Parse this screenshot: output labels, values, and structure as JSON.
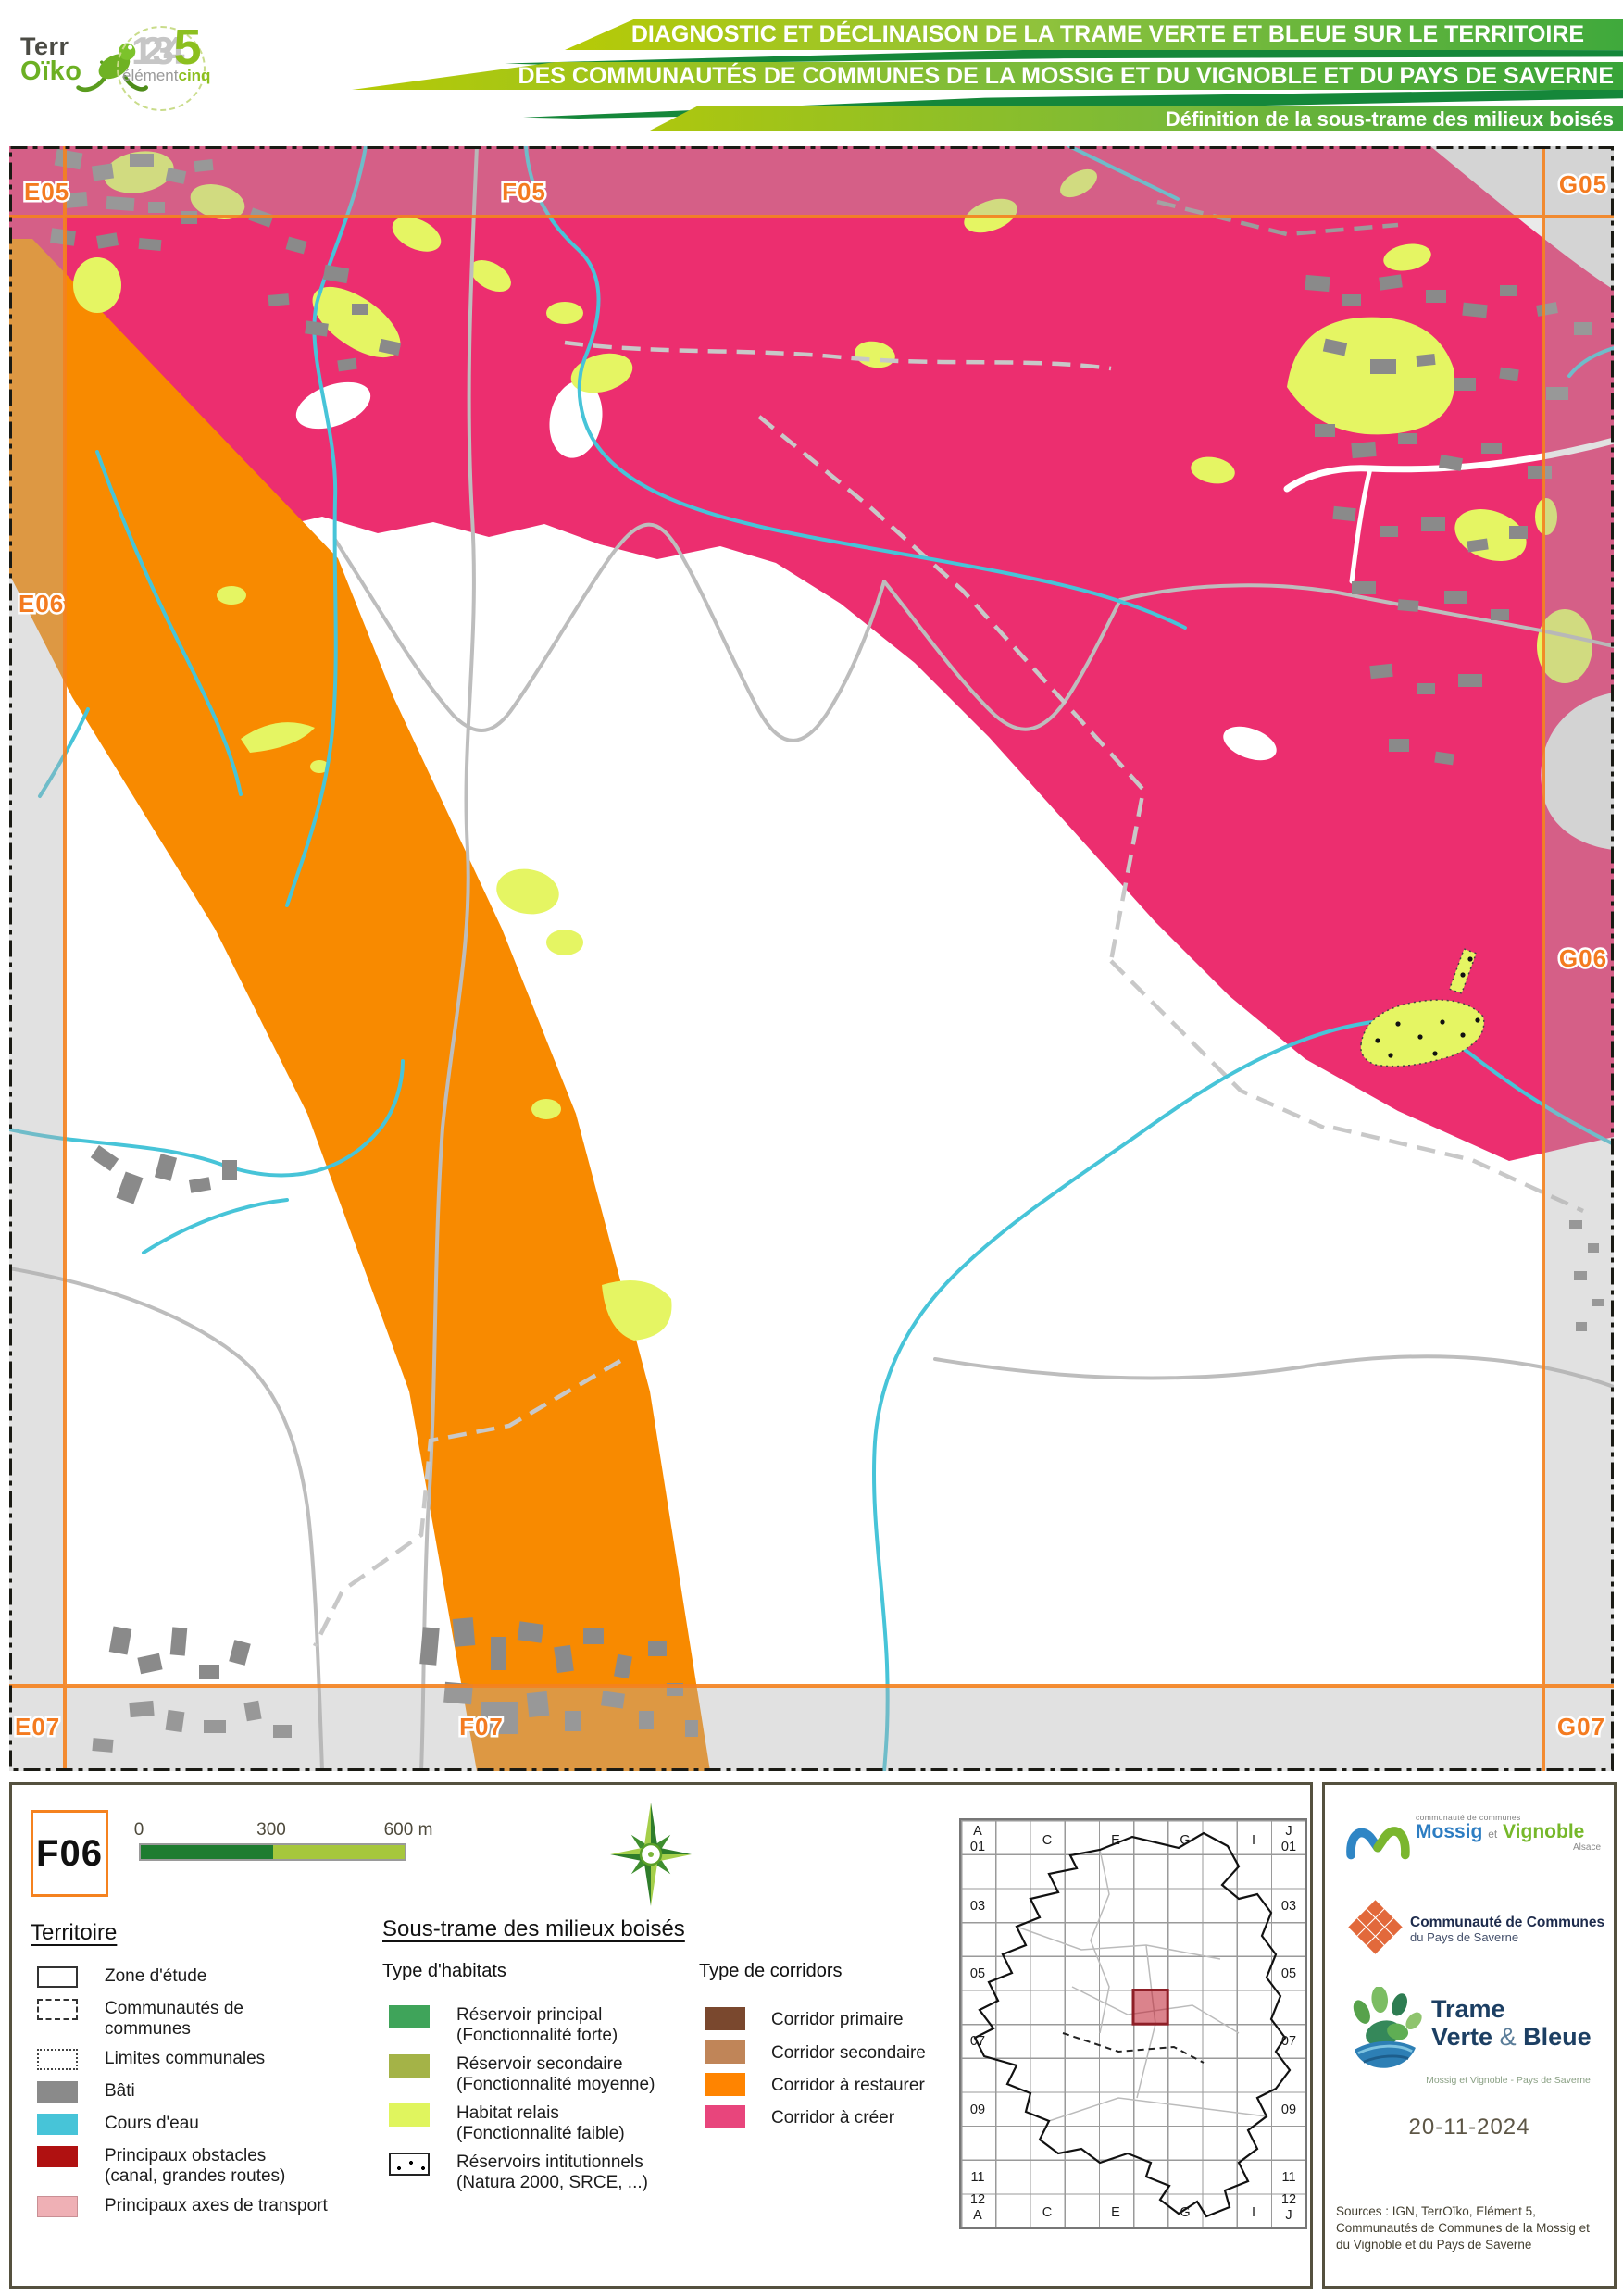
{
  "header": {
    "terroiko_logo": {
      "line1": "Terr",
      "line2": "Oïko"
    },
    "element5_logo": {
      "numbers": "1234",
      "five": "5",
      "word_gray": "élément",
      "word_green": "cinq"
    },
    "title_bar_1": "DIAGNOSTIC ET DÉCLINAISON DE LA TRAME VERTE ET BLEUE SUR LE TERRITOIRE",
    "title_bar_2": "DES COMMUNAUTÉS DE COMMUNES DE LA MOSSIG ET DU VIGNOBLE ET DU PAYS DE SAVERNE",
    "title_bar_3": "Définition de la sous-trame des milieux boisés"
  },
  "map": {
    "grid_labels": [
      {
        "label": "E05"
      },
      {
        "label": "F05"
      },
      {
        "label": "G05"
      },
      {
        "label": "E06"
      },
      {
        "label": "G06"
      },
      {
        "label": "E07"
      },
      {
        "label": "F07"
      },
      {
        "label": "G07"
      }
    ]
  },
  "legend": {
    "page_code": "F06",
    "scale": {
      "tick_start": "0",
      "tick_mid": "300",
      "tick_end": "600 m"
    },
    "territoire": {
      "title": "Territoire",
      "items": [
        {
          "label": "Zone d'étude"
        },
        {
          "label": "Communautés de communes"
        },
        {
          "label": "Limites communales"
        },
        {
          "label": "Bâti"
        },
        {
          "label": "Cours d'eau"
        },
        {
          "label": "Principaux obstacles (canal, grandes routes)"
        },
        {
          "label": "Principaux axes de transport"
        }
      ]
    },
    "soustrame": {
      "title": "Sous-trame des milieux boisés",
      "habitats_title": "Type d'habitats",
      "habitats": [
        {
          "label": "Réservoir principal",
          "sub": "(Fonctionnalité forte)"
        },
        {
          "label": "Réservoir secondaire",
          "sub": "(Fonctionnalité moyenne)"
        },
        {
          "label": "Habitat relais",
          "sub": "(Fonctionnalité faible)"
        },
        {
          "label": "Réservoirs intitutionnels",
          "sub": "(Natura 2000, SRCE, ...)"
        }
      ],
      "corridors_title": "Type de corridors",
      "corridors": [
        {
          "label": "Corridor primaire"
        },
        {
          "label": "Corridor secondaire"
        },
        {
          "label": "Corridor à restaurer"
        },
        {
          "label": "Corridor à créer"
        }
      ]
    }
  },
  "minimap": {
    "rows": [
      "03",
      "05",
      "07",
      "09",
      "11"
    ],
    "cols": [
      "C",
      "E",
      "G",
      "I"
    ],
    "corner_tl": [
      "A",
      "01"
    ],
    "corner_tr": [
      "J",
      "01"
    ],
    "corner_bl": [
      "12",
      "A"
    ],
    "corner_br": [
      "12",
      "J"
    ]
  },
  "footer": {
    "mossig_logo": {
      "small": "communauté de communes",
      "name1": "Mossig",
      "et": "et",
      "name2": "Vignoble",
      "region": "Alsace"
    },
    "saverne_logo": {
      "line1": "Communauté de Communes",
      "line2": "du Pays de Saverne"
    },
    "tvb_logo": {
      "line1": "Trame",
      "line2a": "Verte",
      "amp": "&",
      "line2b": "Bleue",
      "sub": "Mossig et Vignoble - Pays de Saverne"
    },
    "date": "20-11-2024",
    "sources": "Sources : IGN, TerrOïko, Elément 5, Communautés de Communes de la Mossig et du Vignoble et du Pays de Saverne"
  },
  "colors": {
    "corridor_a_creer": "#ec2e6f",
    "corridor_a_restaurer": "#ff8400",
    "corridor_primaire": "#7a482e",
    "corridor_secondaire": "#c08558",
    "reservoir_principal": "#3fa45a",
    "reservoir_secondaire": "#a4b347",
    "habitat_relais": "#e0f55e",
    "bati": "#8a8a8a",
    "cours_eau": "#47c4d8",
    "obstacles": "#b01111",
    "axes_transport": "#efb0b5",
    "grid_orange": "#f5821f",
    "header_green": "#1b8a3b"
  }
}
